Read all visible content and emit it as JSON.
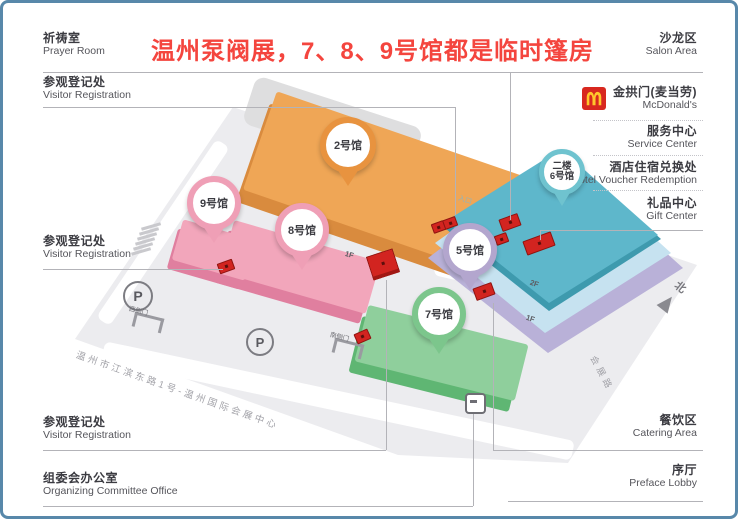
{
  "title": {
    "text": "温州泵阀展，7、8、9号馆都是临时篷房"
  },
  "left_labels": [
    {
      "zh": "祈祷室",
      "en": "Prayer Room"
    },
    {
      "zh": "参观登记处",
      "en": "Visitor Registration"
    },
    {
      "zh": "参观登记处",
      "en": "Visitor Registration"
    },
    {
      "zh": "参观登记处",
      "en": "Visitor Registration"
    },
    {
      "zh": "组委会办公室",
      "en": "Organizing Committee Office"
    }
  ],
  "right_labels": [
    {
      "zh": "沙龙区",
      "en": "Salon Area"
    },
    {
      "zh": "金拱门(麦当劳)",
      "en": "McDonald's"
    },
    {
      "zh": "服务中心",
      "en": "Service Center"
    },
    {
      "zh": "酒店住宿兑换处",
      "en": "Hotel Voucher Redemption"
    },
    {
      "zh": "礼品中心",
      "en": "Gift Center"
    },
    {
      "zh": "餐饮区",
      "en": "Catering Area"
    },
    {
      "zh": "序厅",
      "en": "Preface Lobby"
    }
  ],
  "pins": [
    {
      "label": "2号馆"
    },
    {
      "label": "9号馆"
    },
    {
      "label": "8号馆"
    },
    {
      "floor": "二楼",
      "label": "6号馆"
    },
    {
      "label": "5号馆"
    },
    {
      "label": "7号馆"
    }
  ],
  "map_texts": {
    "road_top": "瓯江路",
    "road_right": "会展路",
    "north": "北",
    "address": "温州市江滨东路1号-温州国际会展中心",
    "parking": "P",
    "floor_1f": "1F",
    "floor_2f": "2F",
    "gate_west": "西侧门",
    "gate_south": "南侧门",
    "roof_entrance": "入口"
  },
  "colors": {
    "frame_border": "#5888aa",
    "title_red": "#f4453e",
    "marker_red": "#d22420",
    "hall2_orange": "#efa656",
    "hall89_pink": "#f2a6bb",
    "hall7_green": "#8fcf9c",
    "hall5_ring": "#b3a6ce",
    "hall6_ring": "#6fc3cf",
    "building_roof_teal": "#5eb7cb",
    "building_2f_blue": "#c6e2f0",
    "building_1f_lavender": "#b9b1d8",
    "mcdonalds_red": "#d8281f",
    "mcdonalds_yellow": "#ffc72c"
  }
}
